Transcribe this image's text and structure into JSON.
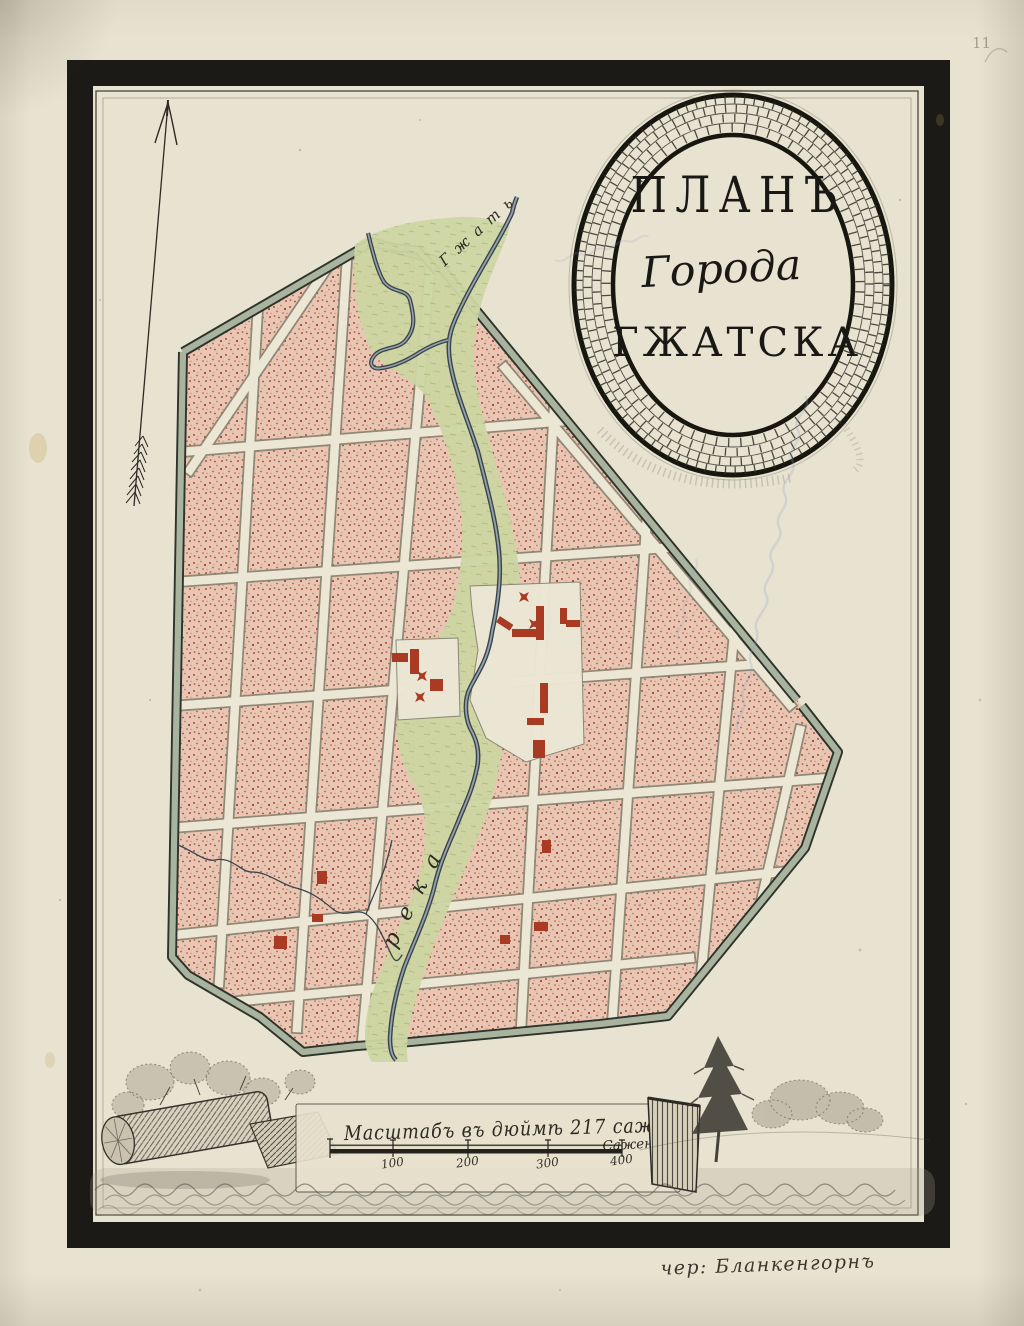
{
  "page": {
    "number": "11"
  },
  "cartouche": {
    "title_line1": "ПЛАНЪ",
    "title_line2": "Города",
    "title_line3": "ГЖАТСКА"
  },
  "map_labels": {
    "river_name_top": "Гжать",
    "river_label": "река"
  },
  "scale": {
    "caption": "Масштабъ въ дюймѣ 217 саж.",
    "unit_label": "Сажен",
    "tick_labels": [
      "100",
      "200",
      "300",
      "400"
    ]
  },
  "footer": {
    "signature": "чер: Бланкенгорнъ"
  },
  "icons": {
    "north_arrow": "feathered-survey-arrow",
    "church_cross": "four-point-red-cross"
  },
  "colors": {
    "paper": "#e8e2d0",
    "frame_black": "#1b1a16",
    "pinstripe": "#4a473c",
    "block_base": "#e7c6b4",
    "block_speckle": "#b44a33",
    "street": "#ece7d5",
    "street_edge": "#86826f",
    "rampart_band": "#a9b49f",
    "rampart_edge": "#2e332c",
    "floodplain_green": "#ccd6a2",
    "river_dark": "#3c434b",
    "river_light": "#92a3ac",
    "building_red": "#a93a24",
    "ink": "#2c2a22",
    "sketch_ink": "#4c4940",
    "ghost_blue": "#8aa2c4",
    "stain": "#c4a964"
  }
}
